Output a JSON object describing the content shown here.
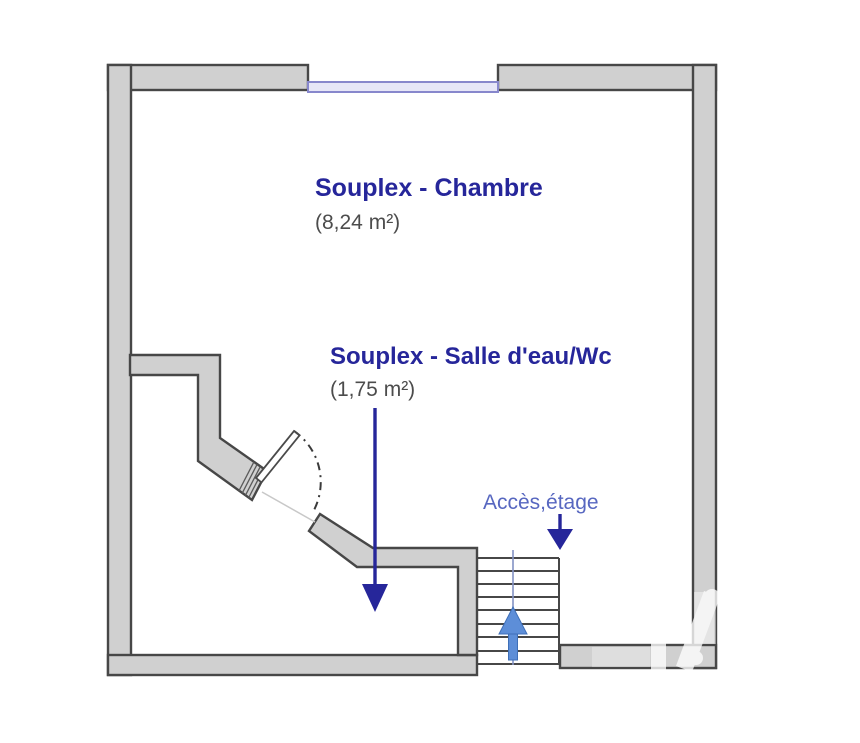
{
  "plan": {
    "rooms": [
      {
        "label": "Souplex - Chambre",
        "area": "(8,24 m²)"
      },
      {
        "label": "Souplex - Salle d'eau/Wc",
        "area": "(1,75 m²)"
      }
    ],
    "access_label": "Accès,étage",
    "icons": {
      "window": "window-symbol",
      "door": "door-swing-symbol",
      "stairs": "staircase-symbol",
      "stairs_direction": "up-arrow",
      "room_pointers": "down-arrow"
    }
  },
  "colors": {
    "pageBg": "#ffffff",
    "wallFill": "#d0d0d0",
    "wallStroke": "#474747",
    "navy": "#26269a",
    "grayText": "#4c4c4c",
    "accessBlue": "#5767c0",
    "windowFill": "#e6e6f7",
    "windowStroke": "#8787cc",
    "stairsBlue": "#5d8ed8",
    "watermarkColor": "#ffffff"
  }
}
